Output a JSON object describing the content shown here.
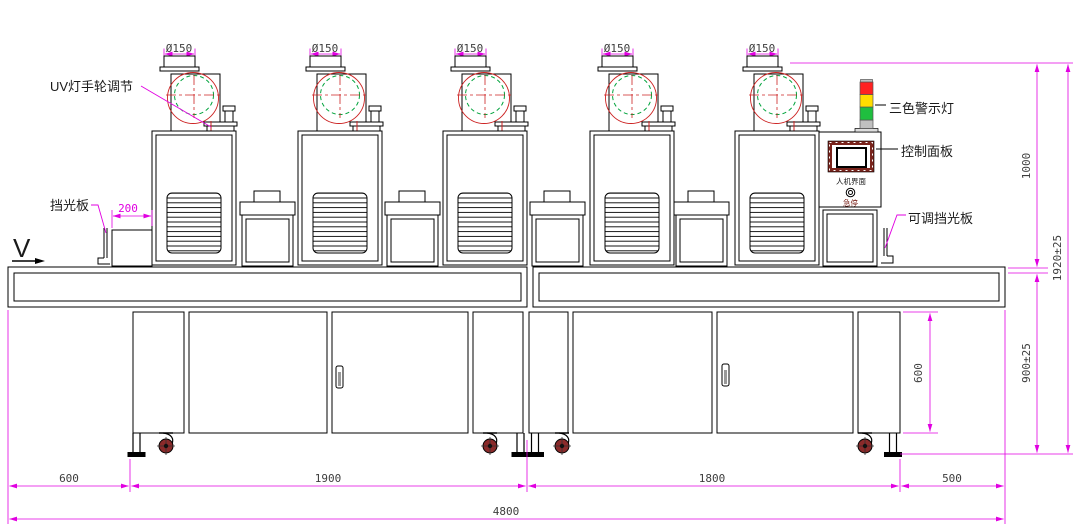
{
  "labels": {
    "uv_handwheel": "UV灯手轮调节",
    "shield": "挡光板",
    "tricolor": "三色警示灯",
    "control_panel": "控制面板",
    "adjustable_shield": "可调挡光板",
    "hmi": "人机界面",
    "estop": "急停",
    "direction": "V"
  },
  "dims": {
    "duct_diameter": "Ø150",
    "offset200": "200",
    "height_top": "1000",
    "height_total": "1920±25",
    "height_table": "900±25",
    "cabinet_height": "600",
    "seg_left": "600",
    "seg_module1": "1900",
    "seg_module2": "1800",
    "seg_right": "500",
    "total_length": "4800"
  },
  "colors": {
    "line": "#000000",
    "dimension": "#E100E1",
    "dim_text": "#3d3d3d",
    "impeller_green": "#00A33C",
    "volute_red": "#CC2222",
    "light_red": "#FF2222",
    "light_yellow": "#FFDD00",
    "light_green": "#1FBF3F",
    "light_base": "#C0C0C0",
    "hmi_frame": "#7A241C",
    "caster": "#8B2A2A"
  }
}
